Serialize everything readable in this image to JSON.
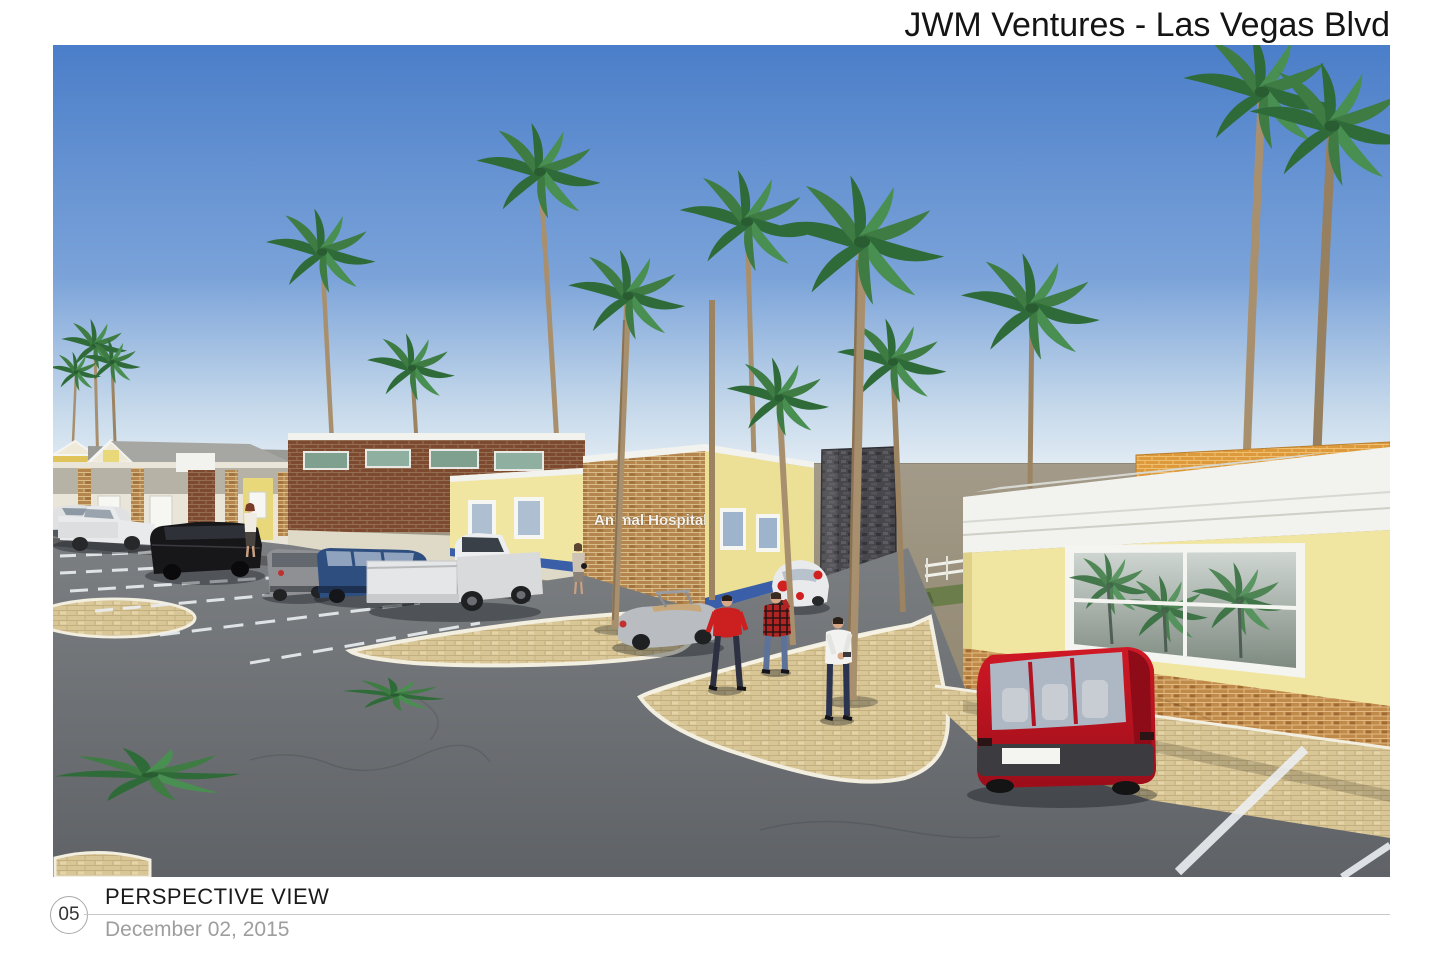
{
  "sheet": {
    "title": "JWM Ventures - Las Vegas Blvd",
    "sheet_number": "05",
    "view_label": "PERSPECTIVE VIEW",
    "date": "December 02, 2015"
  },
  "rendering": {
    "type": "3D architectural perspective rendering",
    "scene": "Single-story commercial retail plaza with an animal hospital, palm trees, desert backdrop, parking lot, paver plaza, pedestrians and parked cars",
    "signage": {
      "animal_hospital_sign": "Animal Hospital"
    },
    "colors": {
      "sky_top": "#4b7ec9",
      "sky_horizon": "#e2ecf4",
      "desert_ground": "#9a9080",
      "asphalt": "#76797d",
      "paver_walkway": "#d9c697",
      "curb_white": "#f2eee0",
      "stucco_yellow": "#f0e6a2",
      "brick_tan": "#b5854e",
      "brick_red_brown": "#7d4a30",
      "brick_orange_parapet": "#dc9a3c",
      "stone_tower_gray": "#47474c",
      "roof_shingle_gray": "#9a9a96",
      "fascia_white": "#f2f2ee",
      "tile_wainscot_blue": "#3a5fa8",
      "palm_frond_green": "#3e7c44",
      "palm_trunk_brown": "#a8906e",
      "minivan_red": "#c01222",
      "suv_dark_blue": "#2e4e80",
      "window_glass": "#8a948c"
    },
    "vehicles": [
      {
        "name": "white-sedan",
        "color": "white"
      },
      {
        "name": "white-pickup-far",
        "color": "white"
      },
      {
        "name": "black-suv",
        "color": "black"
      },
      {
        "name": "gray-wagon",
        "color": "gray"
      },
      {
        "name": "dark-blue-suv",
        "color": "dark blue"
      },
      {
        "name": "white-pickup",
        "color": "white"
      },
      {
        "name": "silver-convertible",
        "color": "silver"
      },
      {
        "name": "white-beetle",
        "color": "white"
      },
      {
        "name": "red-minivan",
        "color": "red"
      }
    ],
    "people": [
      {
        "name": "woman-by-black-suv"
      },
      {
        "name": "woman-at-entrance"
      },
      {
        "name": "man-red-jacket"
      },
      {
        "name": "person-plaid-shirt"
      },
      {
        "name": "man-white-shirt"
      }
    ],
    "palm_tree_count": 14
  }
}
